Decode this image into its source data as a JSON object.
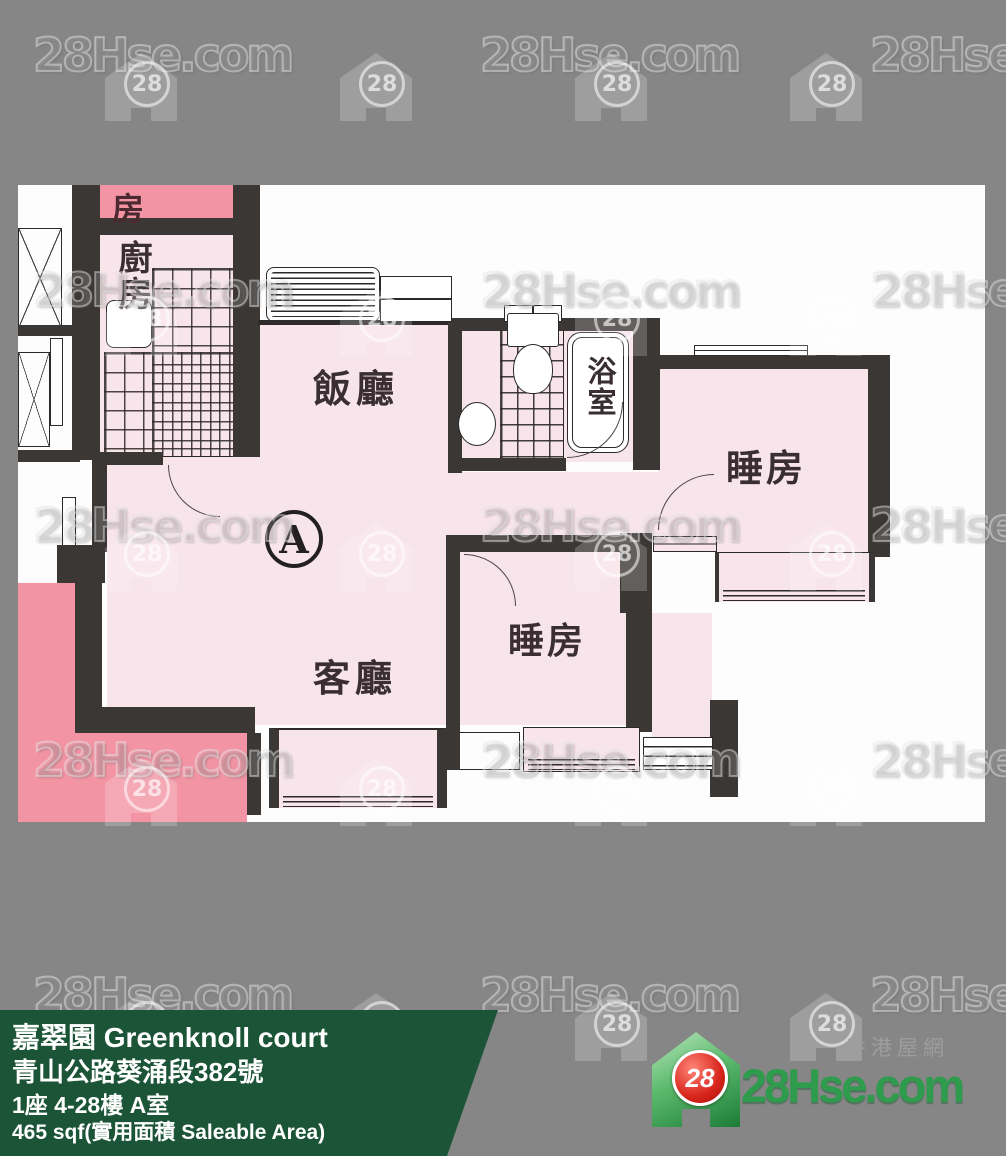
{
  "watermark": {
    "text": "28Hse.com",
    "badge": "28"
  },
  "plan": {
    "marker": "A",
    "rooms": {
      "adjacent_room": "房",
      "kitchen": "廚房",
      "dining": "飯廳",
      "bathroom": "浴室",
      "bedroom_right": "睡房",
      "bedroom_middle": "睡房",
      "living": "客廳"
    }
  },
  "banner": {
    "title": "嘉翠園 Greenknoll court",
    "address": "青山公路葵涌段382號",
    "block_floor_flat": "1座 4-28樓 A室",
    "area": "465 sqf(實用面積 Saleable Area)"
  },
  "logo": {
    "badge": "28",
    "site": "28Hse.com",
    "tagline": "香港屋網"
  },
  "colors": {
    "background_gray": "#868686",
    "banner_green": "#1c5437",
    "unit_pink": "#f8e4eb",
    "adjacent_pink": "#f294a3",
    "wall_black": "#3b3734",
    "logo_green": "#2f9b4d",
    "badge_red": "#d8251c"
  }
}
